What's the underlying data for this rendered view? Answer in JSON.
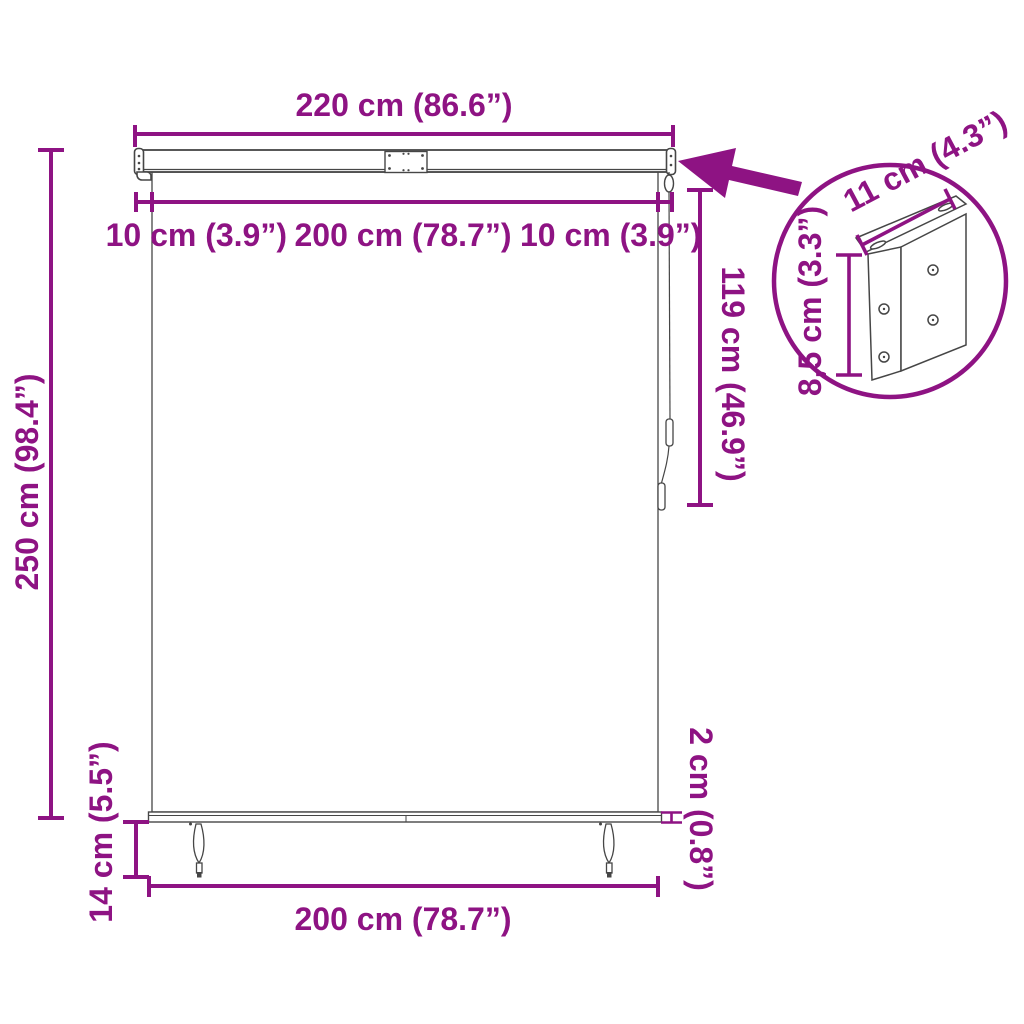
{
  "diagram": {
    "kind": "roller-blind-dimension-diagram",
    "colors": {
      "dimension_color": "#8E1383",
      "outline_color": "#464646",
      "background": "#FFFFFF"
    },
    "labels": {
      "total_width": "220 cm (86.6”)",
      "side_margin_left": "10 cm (3.9”)",
      "fabric_width": "200 cm (78.7”)",
      "side_margin_right": "10 cm (3.9”)",
      "total_height": "250 cm (98.4”)",
      "cord_length": "119 cm (46.9”)",
      "bottom_bar_thickness": "2 cm (0.8”)",
      "handle_length": "14 cm (5.5”)",
      "fabric_width_bottom": "200 cm (78.7”)",
      "bracket_width": "11 cm (4.3”)",
      "bracket_height": "8,5 cm (3.3”)"
    }
  }
}
